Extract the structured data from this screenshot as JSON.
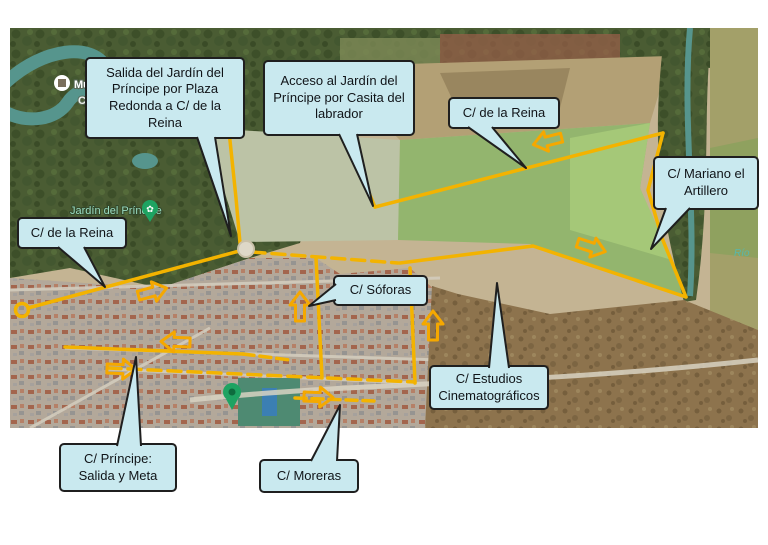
{
  "callouts": {
    "salida": {
      "text": "Salida del Jardín del Príncipe por Plaza Redonda a C/ de la Reina"
    },
    "acceso": {
      "text": "Acceso al Jardín del Príncipe por Casita del labrador"
    },
    "reina_top": {
      "text": "C/ de la Reina"
    },
    "mariano": {
      "text": "C/ Mariano el Artillero"
    },
    "reina_left": {
      "text": "C/ de la Reina"
    },
    "soforas": {
      "text": "C/ Sóforas"
    },
    "estudios": {
      "text": "C/ Estudios Cinematográficos"
    },
    "principe": {
      "text": "C/ Príncipe: Salida y Meta"
    },
    "moreras": {
      "text": "C/ Moreras"
    }
  },
  "map_labels": {
    "museo": "Museo",
    "cen": "Cen",
    "jardin": "Jardín del Príncipe",
    "rio": "Río"
  },
  "colors": {
    "route": "#F3B300",
    "arrow": "#F5A800",
    "callout_bg": "#C9E9EF",
    "callout_border": "#1F1F1F",
    "water": "#56958D"
  }
}
